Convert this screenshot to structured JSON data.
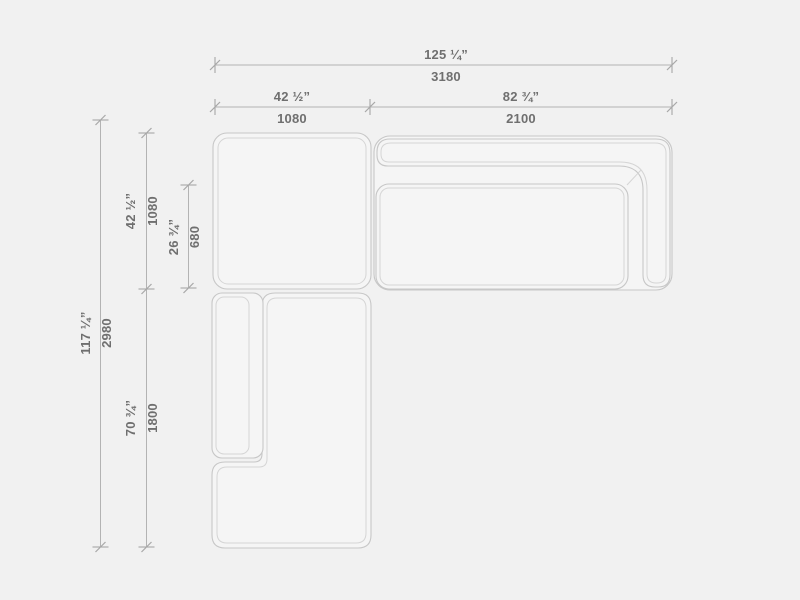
{
  "diagram": {
    "name": "Sectional sofa dimension drawing, top view",
    "view": "plan",
    "units": [
      "inches",
      "mm"
    ],
    "colors": {
      "background": "#f1f1f1",
      "shape_fill": "#f5f5f5",
      "outline": "#c7c7c7",
      "inner_line": "#d5d5d5",
      "dimension_line": "#b3b3b3",
      "tick": "#9e9e9e",
      "text": "#6f6f6f"
    },
    "dims": {
      "total_width": {
        "in": "125 ¼”",
        "mm": "3180"
      },
      "module_left_width": {
        "in": "42 ½”",
        "mm": "1080"
      },
      "module_right_width": {
        "in": "82 ¾”",
        "mm": "2100"
      },
      "total_depth": {
        "in": "117 ¼”",
        "mm": "2980"
      },
      "module_top_depth": {
        "in": "42 ½”",
        "mm": "1080"
      },
      "seat_inner_depth": {
        "in": "26 ¾”",
        "mm": "680"
      },
      "chaise_length": {
        "in": "70 ¾”",
        "mm": "1800"
      }
    }
  }
}
